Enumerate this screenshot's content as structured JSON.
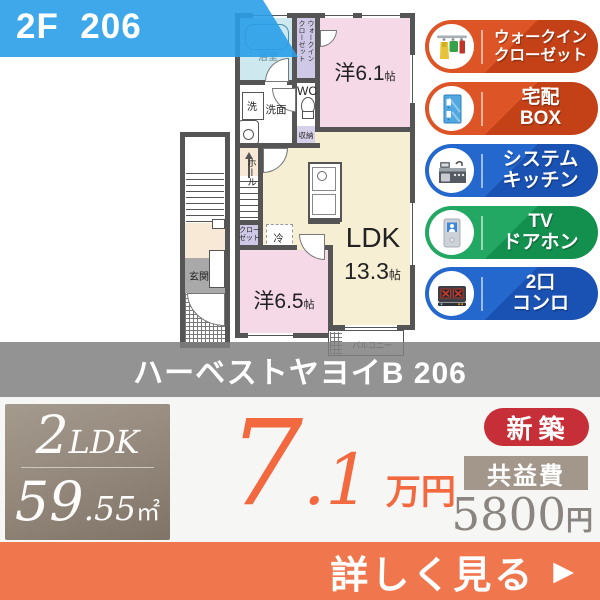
{
  "banner": {
    "label": "2F  206",
    "bg_color": "#299ee9"
  },
  "floorplan": {
    "labels": {
      "bath": "浴室",
      "walkin_l1": "ウォークイン",
      "walkin_l2": "クローゼット",
      "washer": "洗",
      "washroom": "洗面",
      "wc": "WC",
      "storage": "収納",
      "room1_name": "洋6.1",
      "room1_unit": "帖",
      "hall": "ホール",
      "closet_l1": "クロー",
      "closet_l2": "ゼット",
      "fridge": "冷",
      "ldk_name": "LDK",
      "ldk_size": "13.3",
      "ldk_unit": "帖",
      "room2_name": "洋6.5",
      "room2_unit": "帖",
      "balcony": "バルコニー",
      "entrance": "玄関"
    },
    "colors": {
      "wall": "#555555",
      "room_pink": "#f5d9e7",
      "room_cream": "#f6efd4",
      "bath_blue": "#cde9ef",
      "closet_purple": "#cfc9e7",
      "hall_peach": "#f8e8d6",
      "entrance_gray": "#a9a9a9"
    }
  },
  "features": [
    {
      "line1": "ウォークイン",
      "line2": "クローゼット",
      "color": "#d24c1e",
      "icon": "walkin-closet"
    },
    {
      "line1": "宅配",
      "line2": "BOX",
      "color": "#d24c1e",
      "icon": "delivery-box"
    },
    {
      "line1": "システム",
      "line2": "キッチン",
      "color": "#1f5ec4",
      "icon": "system-kitchen"
    },
    {
      "line1": "TV",
      "line2": "ドアホン",
      "color": "#1d9e58",
      "icon": "tv-doorphone"
    },
    {
      "line1": "2口",
      "line2": "コンロ",
      "color": "#1f5ec4",
      "icon": "two-burner-stove"
    }
  ],
  "title_band": {
    "name": "ハーベストヤヨイB 206"
  },
  "summary": {
    "layout": "2LDK",
    "layout_num": "2",
    "layout_type": "LDK",
    "area_int": "59",
    "area_dec": ".55",
    "area_unit": "㎡",
    "rent_int": "7",
    "rent_dec": ".1",
    "rent_unit": "万円",
    "new_badge": "新築",
    "fee_label": "共益費",
    "fee_value": "5800",
    "fee_unit": "円",
    "rent_color": "#f2693f",
    "new_badge_color": "#c62f37"
  },
  "cta": {
    "label": "詳しく見る",
    "arrow": "▶",
    "bg_color": "#f0764e"
  }
}
